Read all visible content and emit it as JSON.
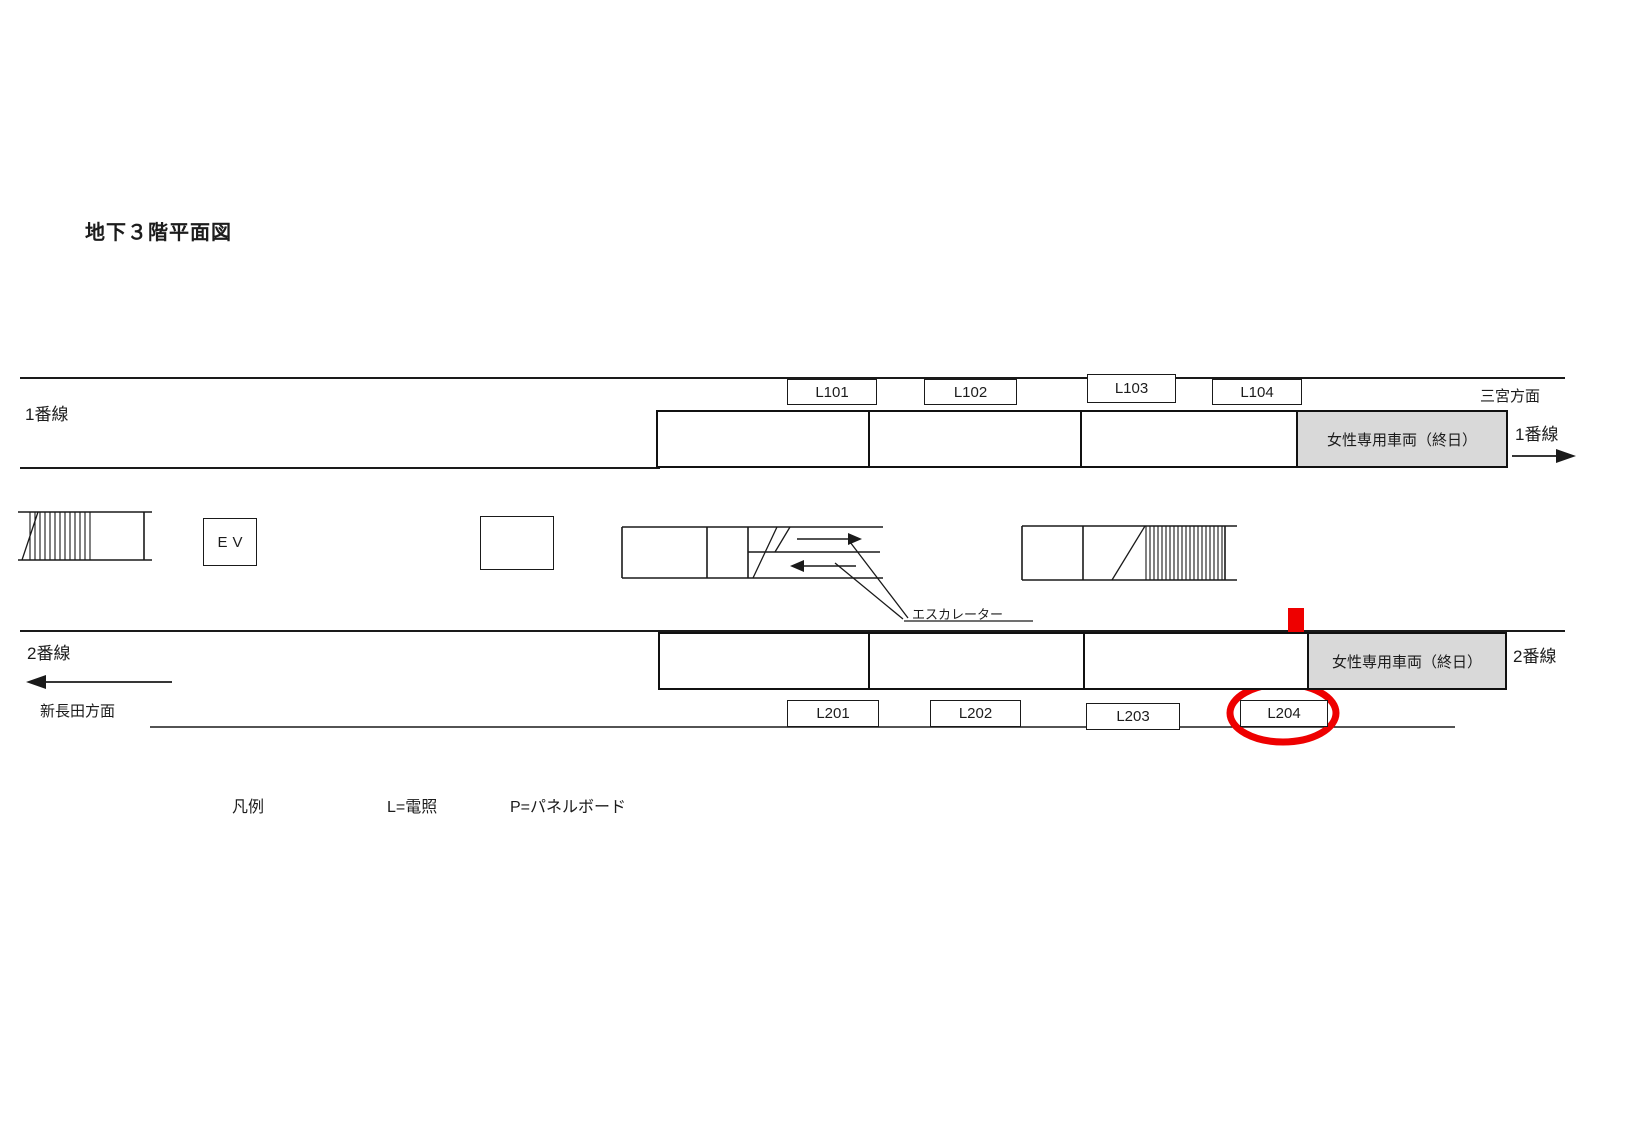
{
  "title": "地下３階平面図",
  "track1": {
    "label_left": "1番線",
    "label_right": "1番線",
    "direction": "三宮方面",
    "panel_labels": [
      "L101",
      "L102",
      "L103",
      "L104"
    ],
    "women_only_car": "女性専用車両（終日）"
  },
  "track2": {
    "label_left": "2番線",
    "label_right": "2番線",
    "direction": "新長田方面",
    "panel_labels": [
      "L201",
      "L202",
      "L203",
      "L204"
    ],
    "women_only_car": "女性専用車両（終日）"
  },
  "concourse": {
    "elevator": "EV",
    "escalator_label": "エスカレーター"
  },
  "legend": {
    "heading": "凡例",
    "items": [
      "L=電照",
      "P=パネルボード"
    ]
  },
  "highlight": {
    "target_panel": "L204",
    "color": "#ee0000"
  }
}
